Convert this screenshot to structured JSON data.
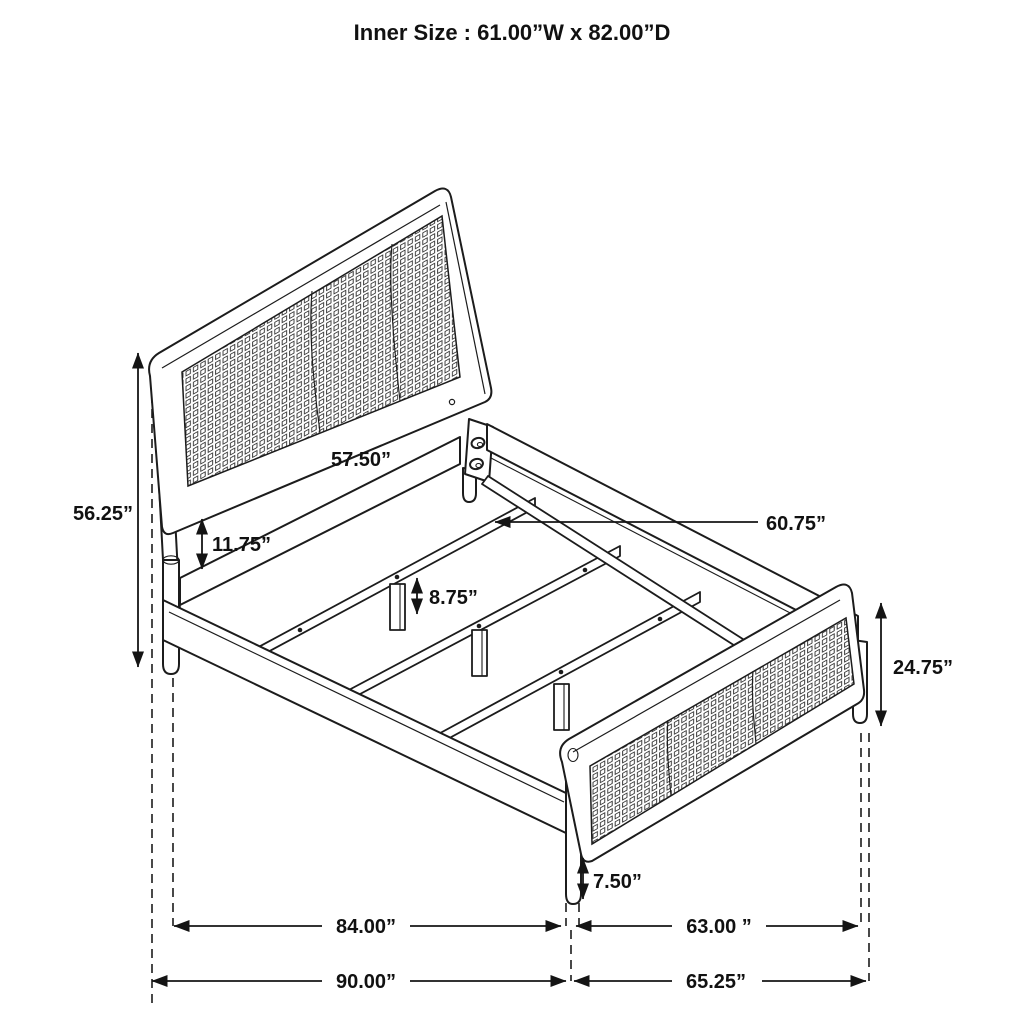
{
  "title": "Inner Size : 61.00”W x 82.00”D",
  "diagram_type": "bed-frame dimension drawing",
  "dimensions": {
    "headboard_height": "56.25”",
    "headboard_panel_to_rail_gap": "11.75”",
    "headboard_width": "57.50”",
    "slat_length": "60.75”",
    "center_leg_height": "8.75”",
    "footboard_height": "24.75”",
    "footboard_leg_height": "7.50”",
    "inner_frame_length": "84.00”",
    "footboard_inner_width": "63.00 ”",
    "outer_frame_length": "90.00”",
    "footboard_outer_width": "65.25”"
  },
  "colors": {
    "line": "#1c1c1c",
    "background": "#ffffff",
    "text": "#111111"
  }
}
